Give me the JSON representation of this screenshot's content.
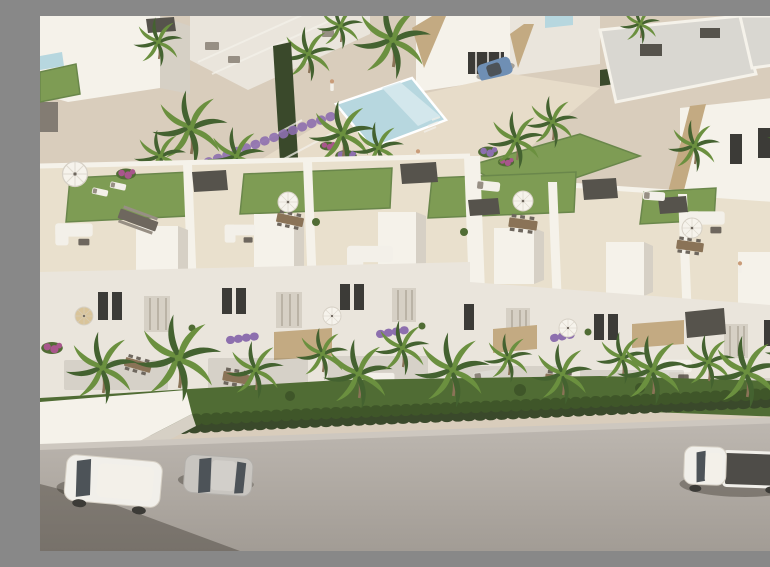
{
  "meta": {
    "domain": "natural-image",
    "description": "Aerial 3D architectural rendering of a modern white residential development: a row of two-storey townhouses with furnished rooftop terraces (artificial lawns, white parasols, lounge sofas, dining sets and dark pergola stair boxes), a communal swimming-pool plaza with palm trees and purple flowering shrubs behind, background villas with flat grey roofs and stone-clad accents, dense hedges and palm trees along the front gardens, and a grey asphalt street in the foreground with a white van, a silver hatchback and a white pickup truck parked."
  },
  "colors": {
    "plaza": "#d9cdbc",
    "plazaLight": "#e7dcc9",
    "plazaShade": "#c2b3a0",
    "whiteLit": "#f5f2ea",
    "white": "#eae5dc",
    "whiteShade": "#d6d0c5",
    "whiteDeep": "#bab3a6",
    "roofGray": "#d9d7d1",
    "roofFloor": "#e9e0cd",
    "stone": "#c3aa82",
    "pergola": "#56534c",
    "charcoal": "#3c3b37",
    "lawn": "#7e9c54",
    "lawnShade": "#6a874b",
    "grass": "#506c34",
    "grassDark": "#3f5629",
    "hedge": "#3a492b",
    "palm1": "#446230",
    "palm2": "#6b903f",
    "wood": "#8a7357",
    "pool": "#b7d7df",
    "poolLight": "#d8eaee",
    "street": "#bdb7b0",
    "streetDark": "#a29c95",
    "sidewalk": "#cdc7bf",
    "shadow": "rgba(50,45,38,0.38)",
    "vanWhite": "#f1efea",
    "silver": "#c8c5c0",
    "glass": "#4d5358",
    "bedDark": "#4e4c48",
    "blueCar": "#6f8fb4",
    "purple": "#8d6fae",
    "magenta": "#a8568c",
    "furn": "#978f84",
    "furnDark": "#6e675e",
    "cloth": "#f3f0e9",
    "umbrella": "#f6f3ec",
    "skin": "#c99c79"
  },
  "scene": {
    "labels": {
      "figure": "Aerial rendering of white townhouse development with pool, palms and street",
      "background": "Background villas with flat grey roofs, stone-clad accents and palm trees",
      "pool_area": "Communal swimming pool plaza with palms and purple flowering shrubs",
      "pool": "Rectangular pool with pale blue water and white deck edge",
      "main_block": "Row of white townhouses with furnished rooftop terraces",
      "roof_terraces": "Rooftop terraces with artificial lawn, parasols, sofas and dining sets",
      "facades": "White facades with shuttered windows, flower balconies and stone panels",
      "front_garden": "Front gardens with grass, hedge row, boundary wall and palm trees",
      "street": "Grey asphalt street with sidewalk and parked vehicles",
      "white_van": "White van parked on the street, left",
      "silver_car": "Silver hatchback parked on the street, centre-left",
      "pickup_truck": "White pickup truck with open dark cargo bed, right",
      "blue_car": "Blue car parked by a background villa, top centre",
      "people": "Small human figures walking in the plaza and on a roof terrace"
    },
    "counts": {
      "townhouse_units_visible": 6,
      "rooftop_lawns": 4,
      "parasols": 7,
      "street_vehicles": 3,
      "background_vehicles": 1,
      "people_visible": 3
    }
  }
}
